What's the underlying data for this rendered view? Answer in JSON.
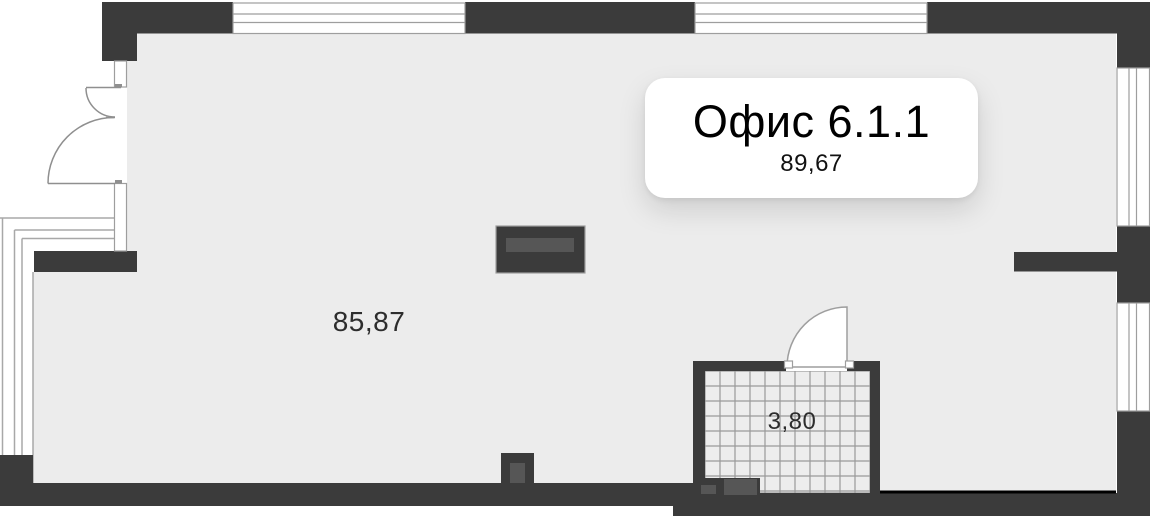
{
  "unit_card": {
    "title": "Офис 6.1.1",
    "area": "89,67"
  },
  "rooms": {
    "office_area": "85,87",
    "bathroom_area": "3,80"
  },
  "palette": {
    "wall": "#3b3b3b",
    "floor": "#ececec",
    "tile_line": "#9a9a9a",
    "outline": "#9e9e9e",
    "inset_gray": "#565656",
    "bottom_edge_line": "#000000",
    "card_bg": "#ffffff",
    "label_text": "#2d2d2d"
  }
}
